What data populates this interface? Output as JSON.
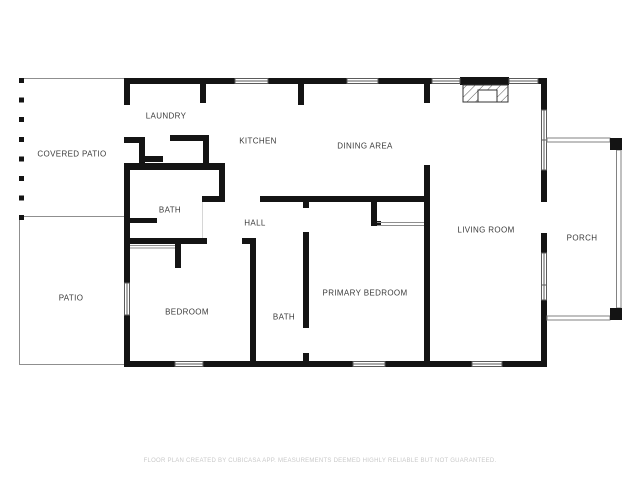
{
  "plan": {
    "rooms": [
      {
        "id": "covered-patio",
        "label": "COVERED PATIO"
      },
      {
        "id": "laundry",
        "label": "LAUNDRY"
      },
      {
        "id": "kitchen",
        "label": "KITCHEN"
      },
      {
        "id": "dining-area",
        "label": "DINING AREA"
      },
      {
        "id": "bath",
        "label": "BATH"
      },
      {
        "id": "hall",
        "label": "HALL"
      },
      {
        "id": "living-room",
        "label": "LIVING ROOM"
      },
      {
        "id": "porch",
        "label": "PORCH"
      },
      {
        "id": "patio",
        "label": "PATIO"
      },
      {
        "id": "bedroom",
        "label": "BEDROOM"
      },
      {
        "id": "bath-2",
        "label": "BATH"
      },
      {
        "id": "primary-bedroom",
        "label": "PRIMARY BEDROOM"
      }
    ],
    "icons": [
      {
        "name": "fireplace-icon",
        "style": "hatched-rectangle"
      },
      {
        "name": "window-icon",
        "style": "double-parallel-lines"
      },
      {
        "name": "porch-post-icon",
        "style": "solid-black-square"
      }
    ],
    "colors": {
      "wall": "#141414",
      "thin_line": "#8f8f8f",
      "window_line": "#5a5a5a",
      "label_text": "#3b3b3b",
      "footer_text": "#c9c9c9",
      "background": "#ffffff"
    }
  },
  "footer": {
    "disclaimer": "FLOOR PLAN CREATED BY CUBICASA APP. MEASUREMENTS DEEMED HIGHLY RELIABLE BUT NOT GUARANTEED."
  }
}
